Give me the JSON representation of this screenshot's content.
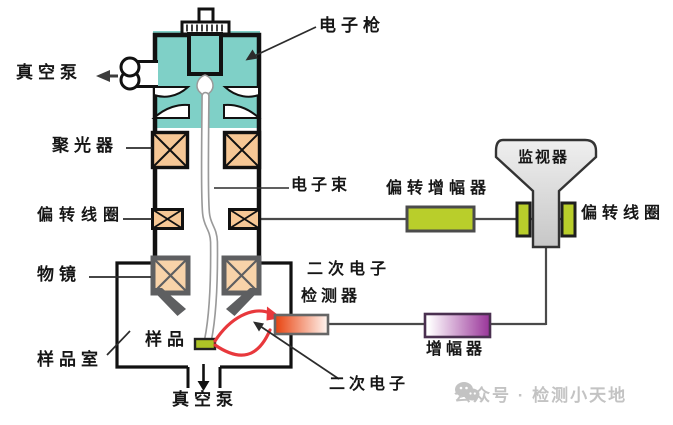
{
  "labels": {
    "electron_gun": "电子枪",
    "vacuum_pump_top": "真空泵",
    "condenser": "聚光器",
    "electron_beam": "电子束",
    "deflection_coil_left": "偏转线圈",
    "deflection_amplifier": "偏转增幅器",
    "monitor": "监视器",
    "deflection_coil_right": "偏转线圈",
    "objective_lens": "物镜",
    "se_detector_line1": "二次电子",
    "se_detector_line2": "检测器",
    "sample": "样品",
    "sample_chamber": "样品室",
    "amplifier": "增幅器",
    "secondary_electron": "二次电子",
    "vacuum_pump_bottom": "真空泵"
  },
  "watermark": {
    "icon": "wechat-icon",
    "text": "公众号 · 检测小天地"
  },
  "colors": {
    "teal": "#7fd0c7",
    "coil_fill": "#f6c795",
    "objective_coil_fill": "#f8d3a9",
    "green": "#b9ce2b",
    "sample_green": "#adc326",
    "red": "#e8383c",
    "detector_left": "#e8420e",
    "detector_right": "#fff6f1",
    "amp_left": "#ffffff",
    "amp_right": "#993499",
    "crt_top": "#efefef",
    "crt_bottom": "#c7c7c7",
    "outline": "#111111",
    "gray_metal": "#5e5f61",
    "wire": "#4a4a4a",
    "watermark_gray": "#c3c3c3"
  }
}
